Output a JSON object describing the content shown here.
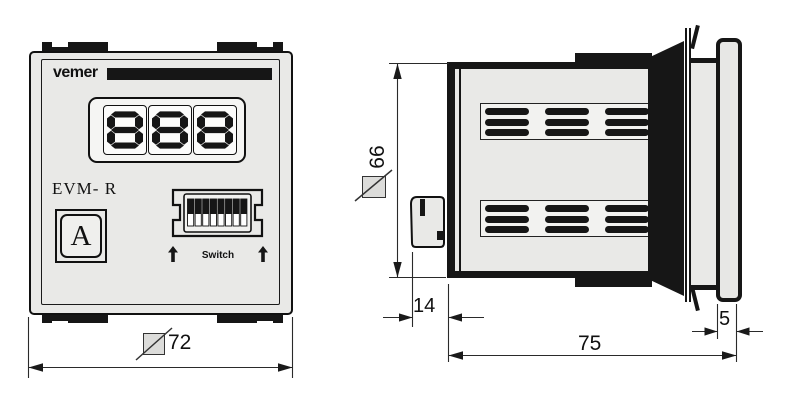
{
  "front_view": {
    "brand_logo": "vemer",
    "display_value": "888",
    "model_label": "EVM- R",
    "button_label": "A",
    "dip_switch": {
      "label": "Switch",
      "count": 8,
      "positions": [
        "up",
        "up",
        "up",
        "up",
        "up",
        "up",
        "up",
        "up"
      ]
    },
    "width_dimension": {
      "value": "72",
      "symbol": "square-with-slash"
    }
  },
  "side_view": {
    "height_dimension": {
      "value": "66",
      "symbol": "square-with-slash"
    },
    "depth_dimension": {
      "value": "75"
    },
    "bezel_thickness_dimension": {
      "value": "5"
    },
    "rear_protrusion_dimension": {
      "value": "14"
    }
  },
  "icons": {
    "dip_arrow": "up-arrow",
    "dimension_symbol": "square-with-slash"
  },
  "colors": {
    "line": "#1a1a1a",
    "case_fill": "#e9e9e7",
    "panel_fill": "#f2f2f0",
    "background": "#ffffff"
  }
}
